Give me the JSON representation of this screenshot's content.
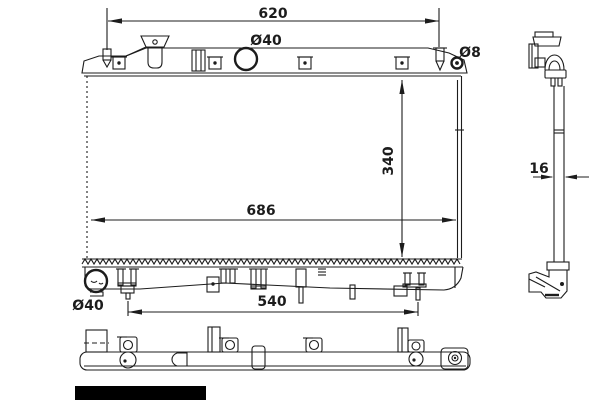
{
  "drawing": {
    "type": "radiator-technical-drawing",
    "labels": {
      "dim_top_width": "620",
      "dim_filler_diameter": "Ø40",
      "dim_pin_diameter": "Ø8",
      "dim_core_height": "340",
      "dim_overall_width": "686",
      "dim_outlet_diameter": "Ø40",
      "dim_bottom_width": "540",
      "dim_thickness": "16"
    },
    "colors": {
      "background": "#ffffff",
      "line": "#1c1c1c",
      "censor": "#000000"
    }
  }
}
